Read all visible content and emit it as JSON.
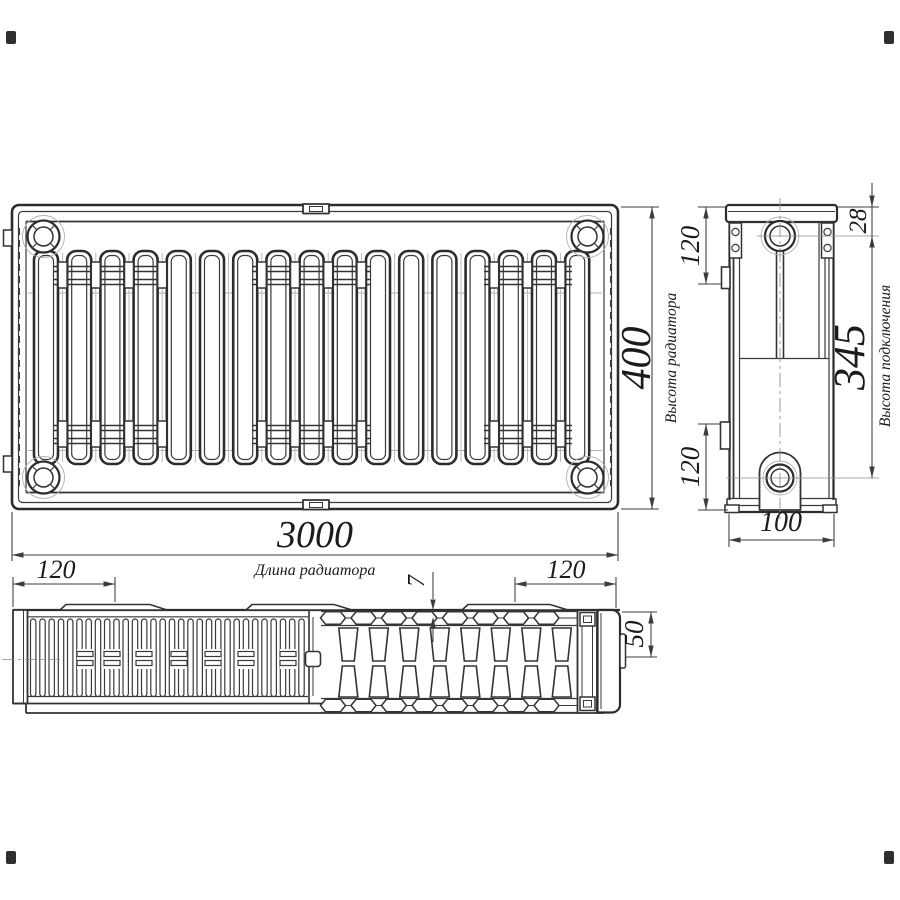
{
  "drawing_title": "Radiator dimensional drawing",
  "dimensions": {
    "length": {
      "value": "3000",
      "label": "Длина радиатора"
    },
    "height": {
      "value": "400",
      "label": "Высота радиатора"
    },
    "connection_height": {
      "value": "345",
      "label": "Высота подключения"
    },
    "top_port_offset": {
      "value": "28"
    },
    "side_bracket_top": {
      "value": "120"
    },
    "side_bracket_bottom": {
      "value": "120"
    },
    "depth": {
      "value": "100"
    },
    "mount_bracket_left": {
      "value": "120"
    },
    "mount_bracket_right": {
      "value": "120"
    },
    "grille_gap": {
      "value": "7"
    },
    "convector_depth": {
      "value": "50"
    }
  },
  "colors": {
    "line": "#2c2c2c",
    "dim": "#3c3c3c",
    "thin": "#b2b2b2",
    "background": "#ffffff"
  }
}
